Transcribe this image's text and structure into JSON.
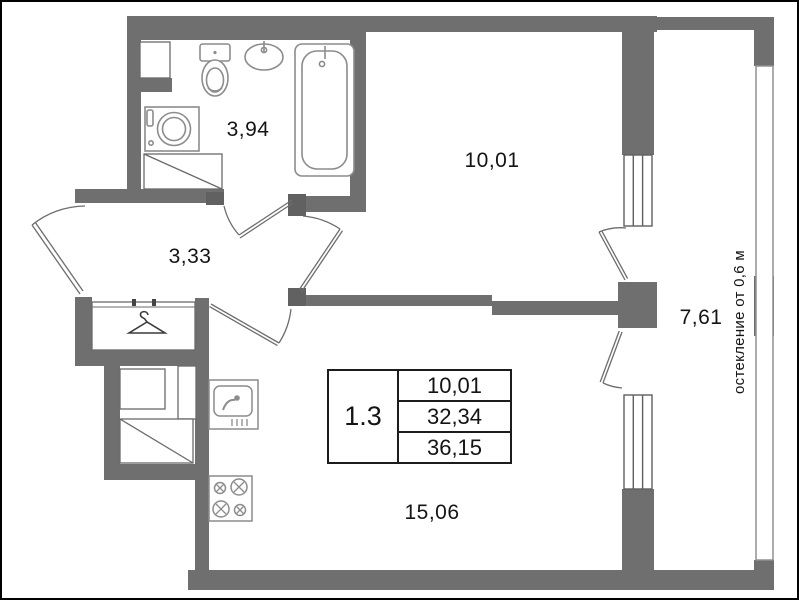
{
  "plan": {
    "unit_label": "1.3",
    "summary": {
      "value1": "10,01",
      "value2": "32,34",
      "value3": "36,15"
    },
    "rooms": {
      "bathroom": "3,94",
      "hallway": "3,33",
      "bedroom": "10,01",
      "living_kitchen": "15,06",
      "balcony": "7,61"
    },
    "balcony_note": "остекление от 0,6 м",
    "colors": {
      "wall": "#6f6f6f",
      "pier": "#616161",
      "fixture_line": "#8c8c8c",
      "text": "#141414",
      "frame_border": "#000000"
    },
    "icons": [
      "toilet-icon",
      "bathroom-sink-icon",
      "bathtub-icon",
      "washing-machine-icon",
      "vent-shaft-icon",
      "hanger-icon",
      "kitchen-sink-icon",
      "stove-icon",
      "window-icon",
      "door-swing-icon",
      "balcony-railing-icon"
    ]
  }
}
